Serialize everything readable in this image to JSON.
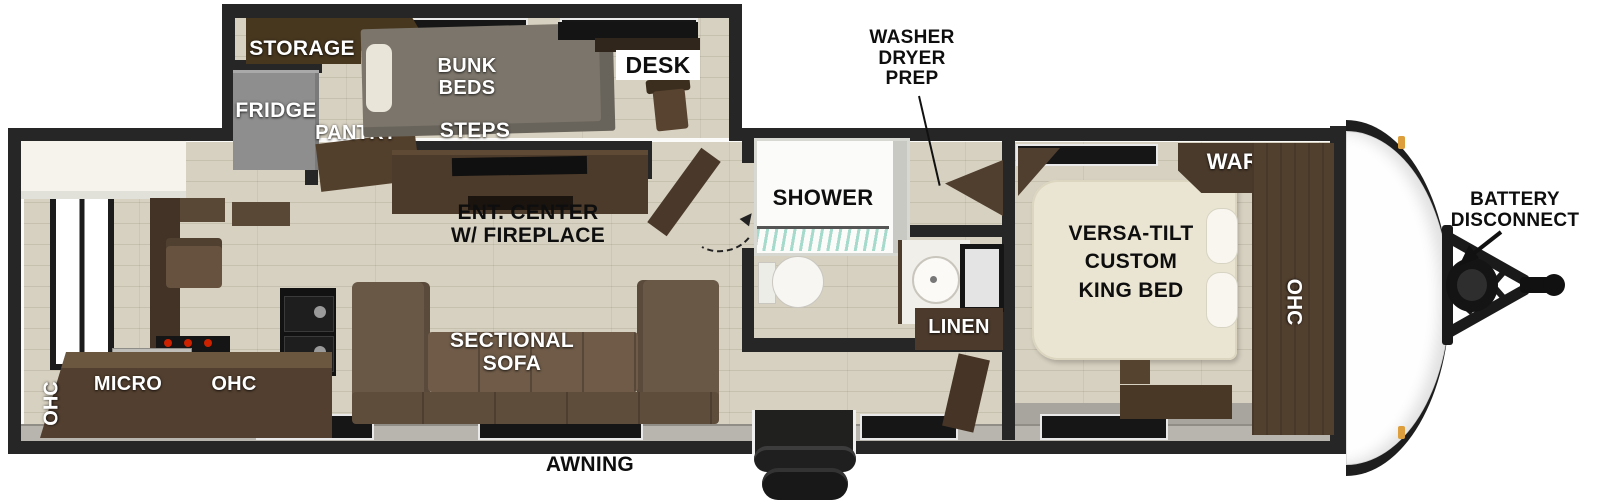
{
  "plan": {
    "bunk_room": {
      "storage": "STORAGE",
      "fridge": "FRIDGE",
      "pantry": "PANTRY",
      "bunk_beds": "BUNK\nBEDS",
      "desk": "DESK",
      "steps": "STEPS"
    },
    "kitchen": {
      "ohc_left": "OHC",
      "micro": "MICRO",
      "ohc_right": "OHC"
    },
    "living": {
      "ent_center": "ENT. CENTER\nW/ FIREPLACE",
      "sofa": "SECTIONAL\nSOFA"
    },
    "bath": {
      "washer_dryer_prep": "WASHER\nDRYER\nPREP",
      "shower": "SHOWER",
      "linen": "LINEN"
    },
    "bedroom": {
      "bed": "VERSA-TILT\nCUSTOM\nKING BED",
      "ward": "WARD",
      "ohc": "OHC"
    },
    "exterior": {
      "battery_disconnect": "BATTERY\nDISCONNECT",
      "awning": "AWNING"
    }
  },
  "colors": {
    "wall": "#262626",
    "floor": "#d7d1c1",
    "cabinet_dark": "#4c3a2a",
    "sofa_brown": "#6a5846",
    "bunk_gray": "#7b756b",
    "fridge_gray": "#8e8e8e",
    "bed_cream": "#eae5d2",
    "clearance_light": "#dd9f3d"
  }
}
